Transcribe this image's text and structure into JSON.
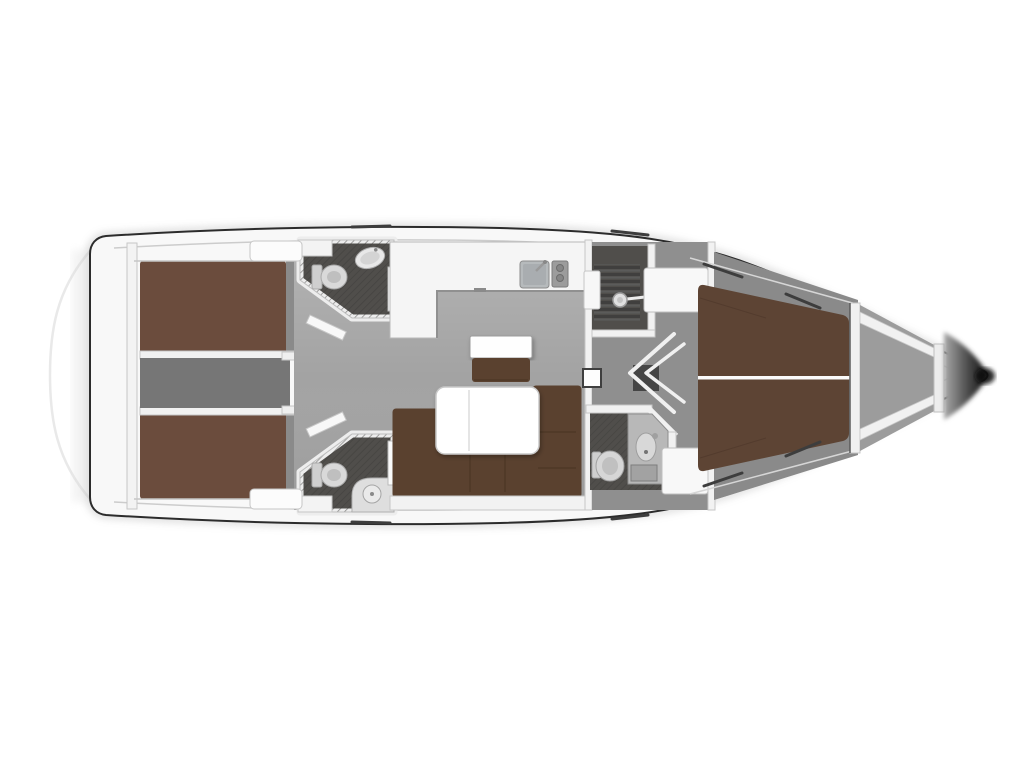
{
  "plan": {
    "kind": "sailing-yacht-interior-floor-plan",
    "view": "top-down",
    "orientation": "bow-right",
    "rooms": [
      "aft-cabin-port",
      "aft-cabin-starboard",
      "aft-head-port",
      "aft-head-starboard",
      "companionway",
      "galley",
      "saloon",
      "shower-room",
      "forward-head",
      "forward-cabin",
      "forepeak"
    ],
    "furniture": [
      "double-berth-aft-port",
      "double-berth-aft-starboard",
      "companionway-steps",
      "galley-counter",
      "galley-sink",
      "galley-stove",
      "saloon-sofa",
      "saloon-table",
      "nav-seat",
      "toilet",
      "washbasin",
      "shower-head",
      "v-berth",
      "wardrobe-lockers",
      "bow-struts"
    ]
  },
  "colors": {
    "background": "#ffffff",
    "hull_line": "#2c2c2c",
    "deck": "#f8f8f8",
    "wall": "#f2f2f2",
    "saloon_floor": "#a3a3a3",
    "corridor_floor": "#8f8f8f",
    "cabin_floor": "#8a8a8a",
    "forepeak_floor": "#9c9c9c",
    "bath_floor": "#504e4b",
    "engine": "#767676",
    "aft_berth": "#6b4c3d",
    "v_berth": "#5d4434",
    "sofa": "#5a412f",
    "sofa_dark": "#4c3625",
    "table": "#ffffff",
    "counter": "#f5f5f5",
    "sink": "#b6babc",
    "fixture": "#d9d9d9",
    "shadow_dark": "#101010"
  }
}
